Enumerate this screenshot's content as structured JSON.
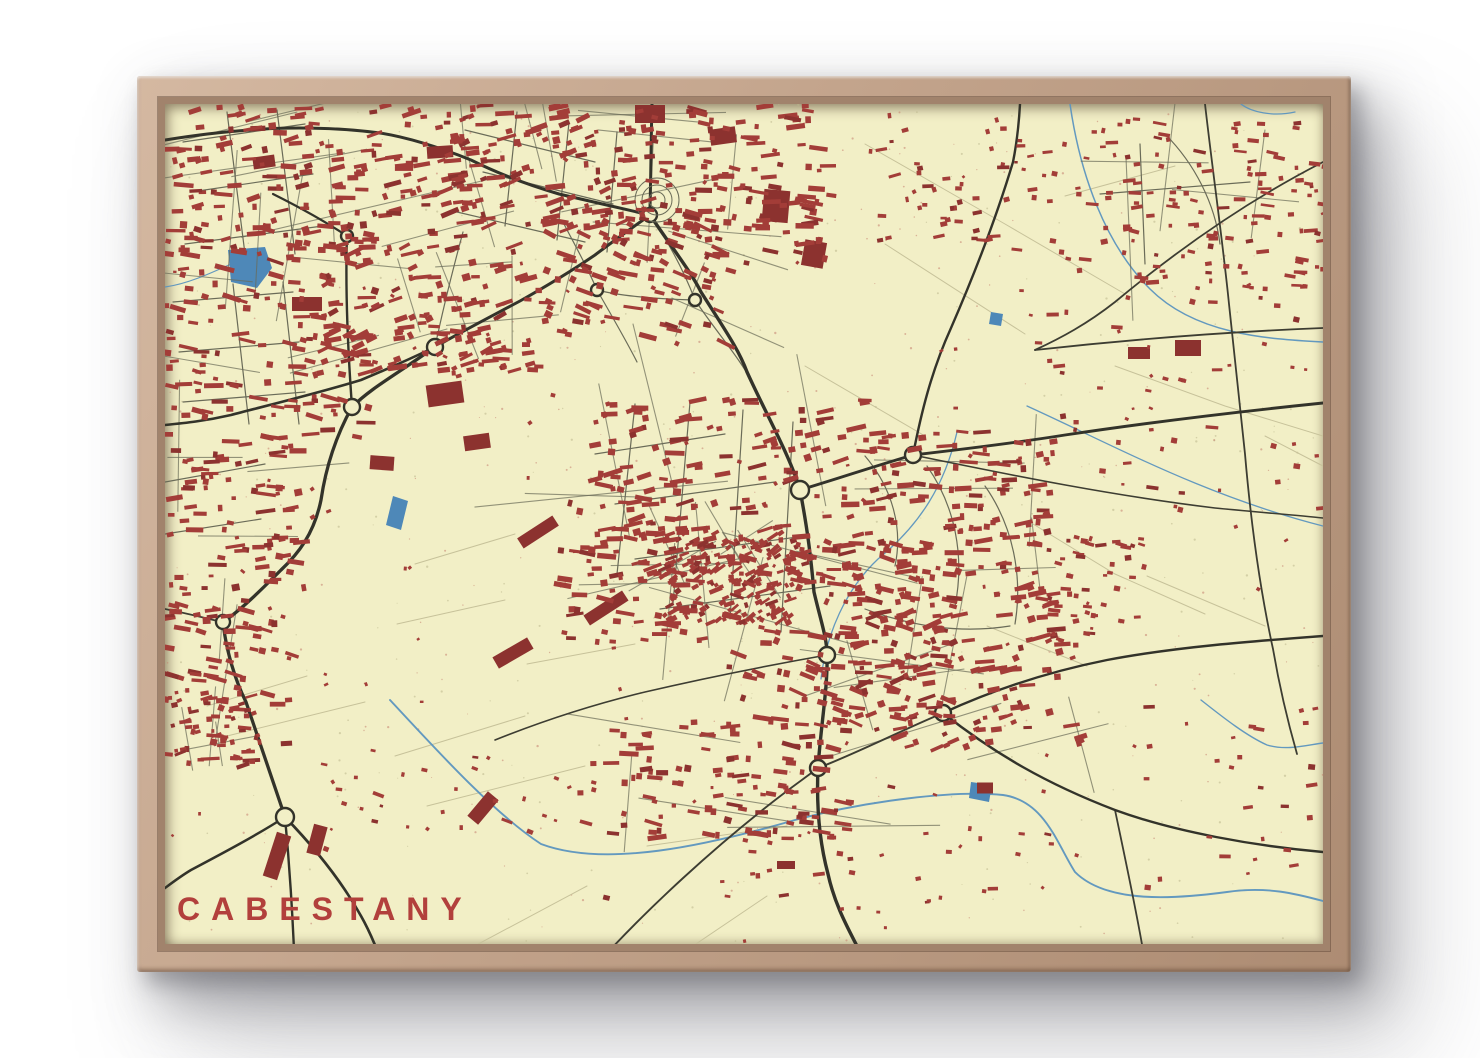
{
  "poster": {
    "title": "CABESTANY",
    "title_color": "#b2403c"
  },
  "frame": {
    "wood": "#c3a48c",
    "wood_light": "#d4b8a1",
    "wood_dark": "#a1836c"
  },
  "map": {
    "bg": "#f2efc6",
    "building": "#a33d38",
    "building_dark": "#8c322f",
    "road_major": "#33332a",
    "road_mid": "#3d3d32",
    "road_minor": "#6a6b58",
    "road_faint": "#c7c29a",
    "water": "#5b93bf",
    "water_fill": "#4e88b8",
    "speckle_red": "#c47f70",
    "speckle_olive": "#bcb78c",
    "clusters": [
      [
        5,
        0,
        300,
        150,
        165,
        -8,
        0
      ],
      [
        0,
        120,
        210,
        215,
        150,
        6,
        0
      ],
      [
        150,
        138,
        200,
        135,
        90,
        -18,
        0
      ],
      [
        0,
        330,
        150,
        185,
        90,
        0,
        0
      ],
      [
        0,
        500,
        130,
        160,
        65,
        8,
        0
      ],
      [
        280,
        0,
        210,
        125,
        125,
        -14,
        0
      ],
      [
        455,
        0,
        215,
        160,
        140,
        4,
        0
      ],
      [
        380,
        115,
        190,
        125,
        90,
        18,
        0
      ],
      [
        255,
        158,
        130,
        112,
        50,
        -5,
        0
      ],
      [
        960,
        15,
        200,
        170,
        110,
        2,
        1
      ],
      [
        835,
        20,
        140,
        150,
        40,
        0,
        2
      ],
      [
        700,
        10,
        150,
        130,
        38,
        -6,
        2
      ],
      [
        430,
        295,
        270,
        185,
        155,
        -8,
        0
      ],
      [
        498,
        428,
        135,
        92,
        150,
        -30,
        1
      ],
      [
        560,
        435,
        240,
        185,
        165,
        12,
        0
      ],
      [
        395,
        375,
        145,
        165,
        80,
        2,
        0
      ],
      [
        445,
        615,
        240,
        125,
        105,
        4,
        0
      ],
      [
        700,
        325,
        190,
        145,
        125,
        -2,
        0
      ],
      [
        690,
        480,
        230,
        165,
        140,
        -14,
        0
      ],
      [
        870,
        430,
        110,
        115,
        50,
        6,
        2
      ],
      [
        150,
        645,
        300,
        155,
        40,
        10,
        2
      ],
      [
        545,
        680,
        360,
        130,
        34,
        0,
        2
      ],
      [
        840,
        180,
        320,
        230,
        50,
        3,
        2
      ],
      [
        980,
        600,
        180,
        200,
        26,
        0,
        2
      ],
      [
        0,
        588,
        95,
        75,
        48,
        -10,
        1
      ]
    ],
    "blocks": [
      [
        280,
        290,
        36,
        22,
        -8
      ],
      [
        312,
        338,
        26,
        15,
        -8
      ],
      [
        142,
        200,
        30,
        14,
        0
      ],
      [
        485,
        10,
        30,
        18,
        0
      ],
      [
        558,
        32,
        26,
        16,
        -8
      ],
      [
        611,
        102,
        26,
        32,
        5
      ],
      [
        649,
        150,
        22,
        26,
        10
      ],
      [
        373,
        428,
        42,
        12,
        -33
      ],
      [
        441,
        504,
        46,
        12,
        -33
      ],
      [
        348,
        549,
        40,
        13,
        -30
      ],
      [
        974,
        249,
        22,
        12,
        0
      ],
      [
        1023,
        244,
        26,
        16,
        0
      ],
      [
        112,
        752,
        15,
        46,
        18
      ],
      [
        152,
        736,
        14,
        30,
        15
      ],
      [
        820,
        684,
        16,
        11,
        0
      ],
      [
        621,
        761,
        18,
        8,
        0
      ],
      [
        217,
        359,
        24,
        14,
        4
      ],
      [
        99,
        58,
        22,
        12,
        -8
      ],
      [
        275,
        48,
        26,
        12,
        -4
      ],
      [
        318,
        704,
        14,
        32,
        40
      ]
    ],
    "major_roads": [
      {
        "d": "M487,0 C486,36 486,70 485,103",
        "w": 3
      },
      {
        "d": "M485,111 C510,148 526,168 536,188 C560,226 574,246 582,268 C602,312 625,352 635,386",
        "w": 3.4
      },
      {
        "d": "M635,386 C643,428 646,455 649,488 C656,518 662,534 662,551 C663,582 656,620 653,664 C651,710 656,744 663,770 C670,802 684,826 694,846",
        "w": 3.4
      },
      {
        "d": "M485,111 C455,104 424,97 394,90 C350,77 322,64 306,56 C271,42 240,33 215,29 C170,23 120,23 85,26 C55,28 25,32 0,36",
        "w": 3
      },
      {
        "d": "M485,111 C464,126 447,138 430,151 C405,168 380,183 355,197 C325,213 296,228 270,243",
        "w": 3
      },
      {
        "d": "M270,243 C245,255 220,266 196,276 C150,290 100,302 66,311 C40,317 20,319 0,321",
        "w": 2.6
      },
      {
        "d": "M264,247 C232,270 206,284 187,303 C172,330 161,362 156,396 C149,430 133,450 116,466 C96,486 76,506 58,518 C61,546 70,576 81,598 C95,640 108,678 120,713",
        "w": 3.3
      },
      {
        "d": "M120,713 C148,742 176,776 196,812 C204,826 208,836 212,846",
        "w": 2.7
      },
      {
        "d": "M120,713 C92,731 60,748 26,766 C16,772 8,778 0,784",
        "w": 2.5
      },
      {
        "d": "M635,386 C672,375 710,362 748,351 C800,345 850,339 900,331 C980,319 1080,307 1158,299",
        "w": 2.9
      },
      {
        "d": "M748,351 C756,310 766,268 786,224 C806,178 830,118 848,58 C852,38 854,18 855,0",
        "w": 2.4
      },
      {
        "d": "M778,609 C830,585 882,568 942,556 C1010,543 1090,537 1158,532",
        "w": 2.4
      },
      {
        "d": "M778,609 C830,650 882,680 950,706 C1010,728 1090,742 1158,748",
        "w": 2.4
      },
      {
        "d": "M182,132 C180,190 183,248 187,303",
        "w": 2.4
      },
      {
        "d": "M182,132 C158,116 132,102 108,90",
        "w": 2.2
      },
      {
        "d": "M120,713 C124,756 127,800 129,846",
        "w": 2.4
      }
    ],
    "mid_roads": [
      {
        "d": "M1040,0 C1048,70 1058,140 1064,200 C1070,260 1076,310 1080,350 C1086,420 1096,490 1108,545 C1114,580 1122,615 1132,650",
        "w": 1.8
      },
      {
        "d": "M870,246 C960,236 1060,228 1158,224",
        "w": 1.8
      },
      {
        "d": "M1158,58 C1080,98 1010,148 950,198 C922,220 896,234 870,246",
        "w": 1.8
      },
      {
        "d": "M748,351 C850,372 950,392 1050,404 C1090,408 1130,411 1158,414",
        "w": 1.6
      },
      {
        "d": "M662,551 C600,562 540,574 480,588 C430,600 380,616 330,636",
        "w": 1.6
      },
      {
        "d": "M0,505 C20,509 40,514 57,518",
        "w": 1.8
      },
      {
        "d": "M445,846 C490,798 545,748 595,708 C622,686 640,674 653,664",
        "w": 1.9
      },
      {
        "d": "M950,706 C960,754 970,800 978,846",
        "w": 1.8
      },
      {
        "d": "M653,664 C690,650 735,627 778,609",
        "w": 2
      }
    ],
    "minor_roads": [
      "M485,111 C505,140 520,170 530,196",
      "M530,196 C550,226 568,246 580,266",
      "M432,186 C455,192 495,195 530,196",
      "M432,186 C420,158 408,138 398,118",
      "M432,186 C448,214 462,238 472,258",
      "M270,243 C278,205 288,165 298,128",
      "M430,350 L560,330",
      "M450,400 L610,378",
      "M470,455 L640,432",
      "M495,505 L665,482",
      "M470,300 L452,470",
      "M525,298 L508,500",
      "M578,306 L565,515",
      "M628,318 L616,528",
      "M700,352 C728,385 738,425 730,462",
      "M762,362 C790,402 800,452 790,502",
      "M820,382 C848,422 858,472 850,520",
      "M700,505 C745,522 795,530 845,522",
      "M300,26 L430,58",
      "M318,68 L448,100",
      "M292,108 L420,138",
      "M352,8 L340,122",
      "M404,18 L392,136",
      "M452,28 L442,148",
      "M18,38 L140,20",
      "M26,88 L148,70",
      "M20,140 L158,122",
      "M62,8 L80,150",
      "M112,6 L130,150",
      "M8,198 L128,188",
      "M14,248 L134,238",
      "M18,298 L140,288",
      "M68,180 L84,320",
      "M118,178 L134,320",
      "M0,378 L100,360",
      "M0,430 L96,415",
      "M975,40 L980,160",
      "M935,90 L1085,78",
      "M1000,30 C1030,60 1050,100 1055,140"
    ],
    "faint_roads": [
      "M700,40 L840,120 L960,190",
      "M720,140 L860,230",
      "M640,262 L760,332",
      "M230,652 L360,612",
      "M62,632 L200,598",
      "M262,702 L420,662",
      "M482,742 L622,722",
      "M302,846 L422,782",
      "M522,846 L602,792",
      "M900,92 L1010,62",
      "M1100,332 L1158,362",
      "M950,262 L1060,302 L1158,332",
      "M822,522 L922,562",
      "M982,472 L1100,522",
      "M42,602 L142,572",
      "M868,420 L950,470 L1040,510",
      "M362,560 L470,540",
      "M250,460 L350,430",
      "M232,520 L340,496"
    ],
    "streams": [
      {
        "d": "M905,0 C915,70 940,140 985,185 C1030,230 1100,235 1158,238",
        "w": 1.5
      },
      {
        "d": "M792,328 C780,380 756,420 713,455 C681,485 661,530 656,575",
        "w": 1.3
      },
      {
        "d": "M225,596 C275,650 330,710 376,740 C440,764 540,742 630,716 C700,697 790,686 838,691 C880,697 892,740 910,768 C942,800 1010,795 1062,788 C1102,782 1132,790 1158,797",
        "w": 1.9
      },
      {
        "d": "M1036,596 C1060,615 1082,632 1102,641 C1122,647 1142,641 1158,639",
        "w": 1.4
      },
      {
        "d": "M66,160 C44,170 22,180 0,183",
        "w": 1.2
      },
      {
        "d": "M1076,0 C1086,8 1108,13 1130,8",
        "w": 1.2
      },
      {
        "d": "M862,302 C950,342 1040,392 1158,422",
        "w": 1.3
      }
    ],
    "ponds": [
      "63,146 100,143 107,164 92,184 66,178",
      "228,392 243,397 236,426 221,421",
      "806,678 827,681 824,698 804,694",
      "826,208 838,210 836,222 824,220"
    ],
    "roundabouts": [
      [
        485,
        111,
        7
      ],
      [
        270,
        243,
        8
      ],
      [
        182,
        132,
        6
      ],
      [
        187,
        303,
        8
      ],
      [
        58,
        518,
        7
      ],
      [
        120,
        713,
        9
      ],
      [
        635,
        386,
        9
      ],
      [
        748,
        351,
        8
      ],
      [
        662,
        551,
        8
      ],
      [
        653,
        664,
        8
      ],
      [
        778,
        609,
        8
      ],
      [
        432,
        186,
        6
      ],
      [
        530,
        196,
        6
      ]
    ],
    "rings": {
      "cx": 492,
      "cy": 96,
      "radii": [
        8,
        15,
        22
      ]
    }
  }
}
